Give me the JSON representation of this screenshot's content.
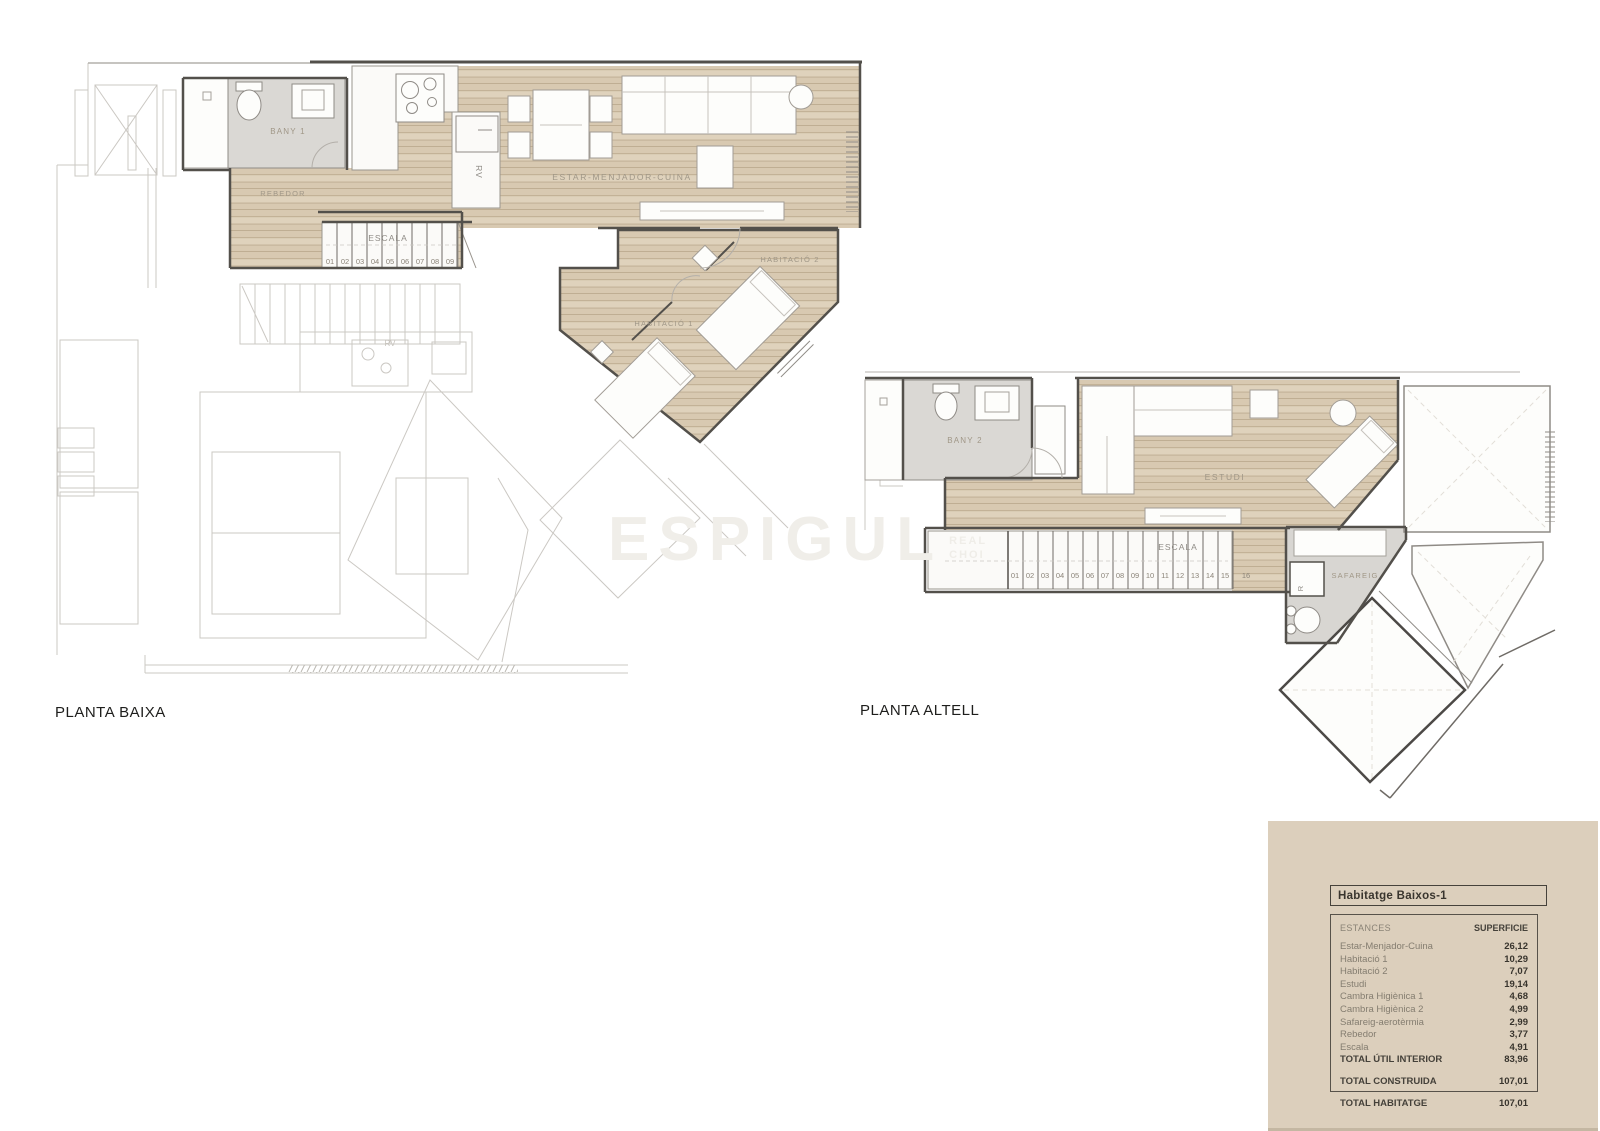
{
  "watermark": {
    "text": "ESPIGUL",
    "sub1": "REAL",
    "sub2": "CHOI"
  },
  "plans": {
    "baixa": {
      "title": "PLANTA BAIXA",
      "rooms": {
        "bany1": "BANY 1",
        "rebedor": "REBEDOR",
        "escala": "ESCALA",
        "estar": "ESTAR-MENJADOR-CUINA",
        "hab1": "HABITACIÓ 1",
        "hab2": "HABITACIÓ 2",
        "rv": "RV",
        "rv_faint": "RV"
      },
      "stairs": [
        "01",
        "02",
        "03",
        "04",
        "05",
        "06",
        "07",
        "08",
        "09"
      ]
    },
    "altell": {
      "title": "PLANTA ALTELL",
      "rooms": {
        "bany2": "BANY 2",
        "estudi": "ESTUDI",
        "escala": "ESCALA",
        "safareig": "SAFAREIG",
        "r": "R"
      },
      "stairs": [
        "01",
        "02",
        "03",
        "04",
        "05",
        "06",
        "07",
        "08",
        "09",
        "10",
        "11",
        "12",
        "13",
        "14",
        "15",
        "16"
      ]
    }
  },
  "legend": {
    "title": "Habitatge Baixos-1",
    "col_estances": "ESTANCES",
    "col_superficie": "SUPERFICIE",
    "rows": [
      {
        "label": "Estar-Menjador-Cuina",
        "value": "26,12"
      },
      {
        "label": "Habitació 1",
        "value": "10,29"
      },
      {
        "label": "Habitació 2",
        "value": "7,07"
      },
      {
        "label": "Estudi",
        "value": "19,14"
      },
      {
        "label": "Cambra Higiènica 1",
        "value": "4,68"
      },
      {
        "label": "Cambra Higiènica 2",
        "value": "4,99"
      },
      {
        "label": "Safareig-aerotèrmia",
        "value": "2,99"
      },
      {
        "label": "Rebedor",
        "value": "3,77"
      },
      {
        "label": "Escala",
        "value": "4,91"
      }
    ],
    "total_util": {
      "label": "TOTAL ÚTIL INTERIOR",
      "value": "83,96"
    },
    "total_construida": {
      "label": "TOTAL CONSTRUIDA",
      "value": "107,01"
    },
    "total_habitatge": {
      "label": "TOTAL HABITATGE",
      "value": "107,01"
    }
  }
}
